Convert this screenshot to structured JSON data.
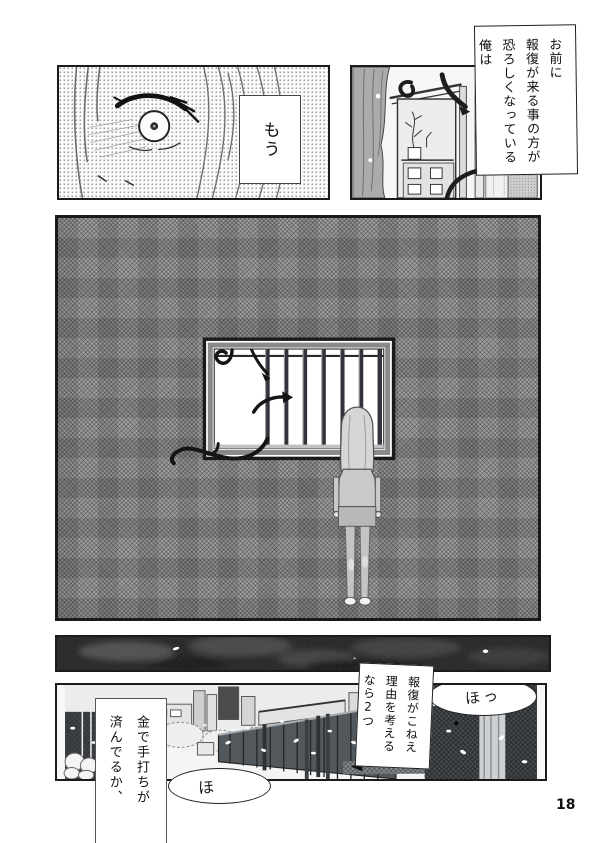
{
  "page": {
    "number": "18"
  },
  "colors": {
    "paper": "#ffffff",
    "ink": "#1a1a1a",
    "wall": "#929292",
    "night": "#141414",
    "fence": "#53585c",
    "tentacle": "#1d1d1d"
  },
  "captions": {
    "fear": {
      "lines": [
        "お前に",
        "報復が来る事の方が",
        "恐ろしくなっている",
        "俺は"
      ]
    },
    "reason": {
      "lines": [
        "報復がこねえ",
        "理由を考える",
        "なら2つ"
      ]
    },
    "money": {
      "lines": [
        "金で手打ちが",
        "済んでるか、"
      ]
    }
  },
  "balloons": {
    "mou": "もう",
    "ho_top": "ほっ",
    "ho_bottom": "ほ"
  }
}
